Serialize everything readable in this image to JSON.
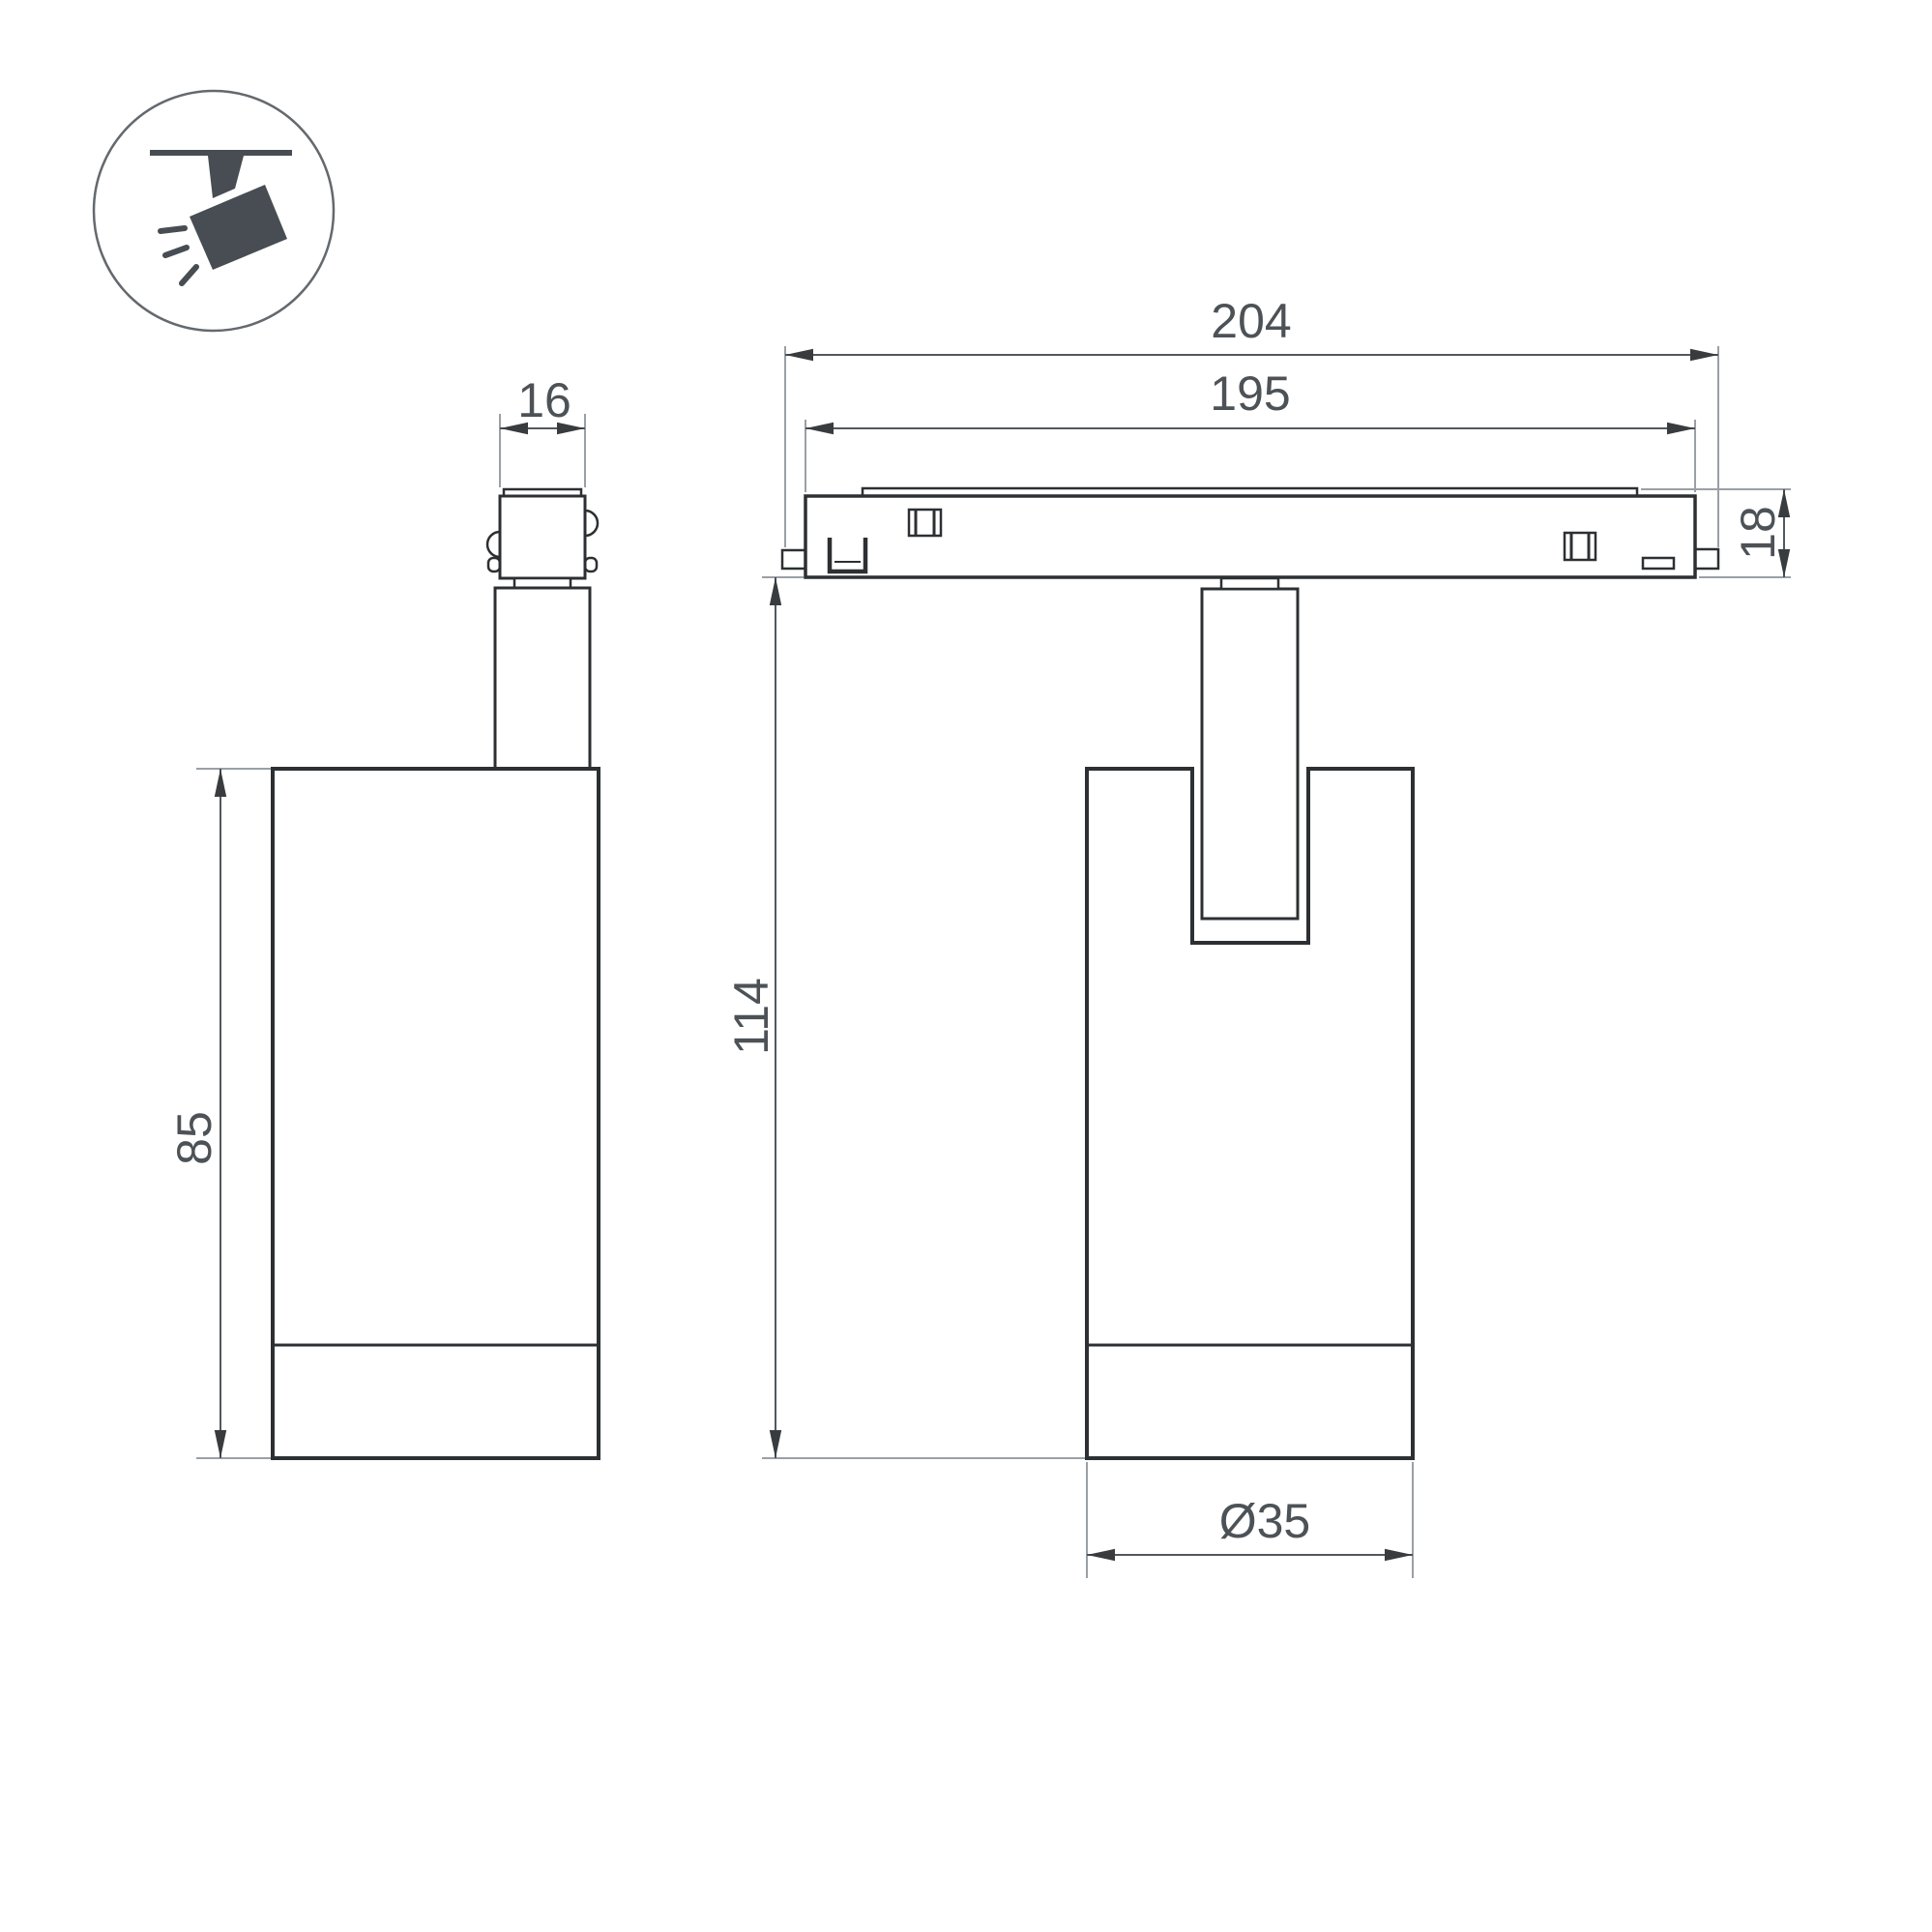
{
  "drawing": {
    "type": "technical-dimension-drawing",
    "subject": "track-mounted spotlight luminaire, two orthographic views",
    "background_color": "#ffffff",
    "colors": {
      "outline": "#2d3033",
      "dimension_line": "#53585d",
      "extension_line": "#9aa0a5",
      "arrow": "#383c3f",
      "label_text": "#4d5257",
      "icon_fill": "#474d53",
      "icon_ring": "#64696e"
    },
    "legend_icon": {
      "name": "ceiling-track-spotlight-icon",
      "description": "circle badge with dark spotlight hanging from track emitting light rays"
    },
    "views": {
      "side": {
        "labels": {
          "connector_width": "16",
          "body_height": "85"
        }
      },
      "front": {
        "labels": {
          "track_outer_length": "204",
          "track_inner_length": "195",
          "track_height": "18",
          "overall_height": "114",
          "body_diameter": "Ø35"
        }
      }
    }
  }
}
